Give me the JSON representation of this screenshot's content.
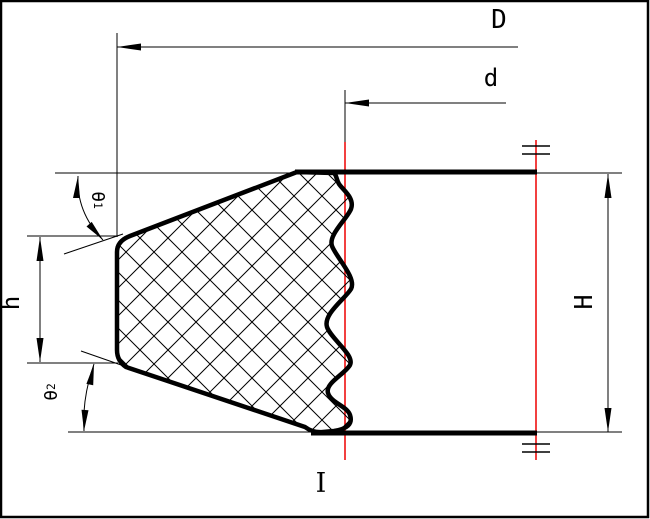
{
  "labels": {
    "outer_diameter": "D",
    "inner_diameter": "d",
    "total_height": "H",
    "lip_height": "h",
    "theta1_base": "θ",
    "theta1_sub": "1",
    "theta2_base": "θ",
    "theta2_sub": "2",
    "section": "I"
  },
  "colors": {
    "line": "#000000",
    "centerline": "#ee0000",
    "background": "#ffffff"
  }
}
